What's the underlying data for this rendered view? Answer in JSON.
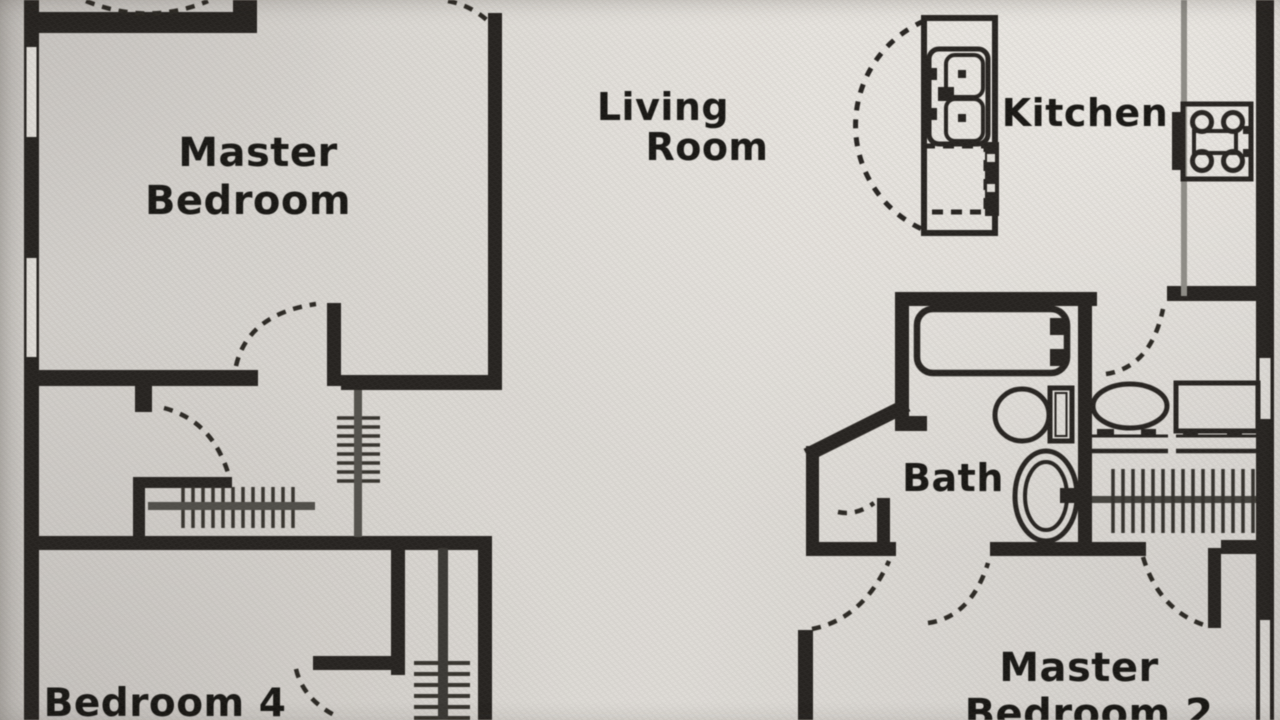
{
  "document": {
    "kind": "scanned floor plan photo",
    "floor": "single level shown, edges cropped by photo"
  },
  "palette": {
    "paper": "#d9d6d1",
    "paper_light": "#e4e1dc",
    "wall_ink": "#292623",
    "label_ink": "#1b1a17",
    "counter_gray": "#8f8d87",
    "rail_gray": "#514f4a"
  },
  "rooms": {
    "master_bedroom": {
      "label_line1": "Master",
      "label_line2": "Bedroom"
    },
    "living_room": {
      "label_line1": "Living",
      "label_line2": "Room"
    },
    "kitchen": {
      "label": "Kitchen"
    },
    "bath": {
      "label": "Bath"
    },
    "bedroom4": {
      "label": "Bedroom 4"
    },
    "master_bedroom2": {
      "label_line1": "Master",
      "label_line2": "Bedroom 2"
    }
  },
  "fixtures": [
    "kitchen-island-with-arc-counter",
    "double-basin-sink",
    "dishwasher-dashed",
    "range-cooktop-4-burners",
    "bathtub-with-faucet",
    "toilet-with-tank",
    "oval-garden-tub",
    "vanity-oval-sink",
    "second-vanity-counter",
    "wire-shelf-closet",
    "staircase-upper",
    "staircase-mid",
    "staircase-lower",
    "door-swing-arcs",
    "wall-windows"
  ]
}
